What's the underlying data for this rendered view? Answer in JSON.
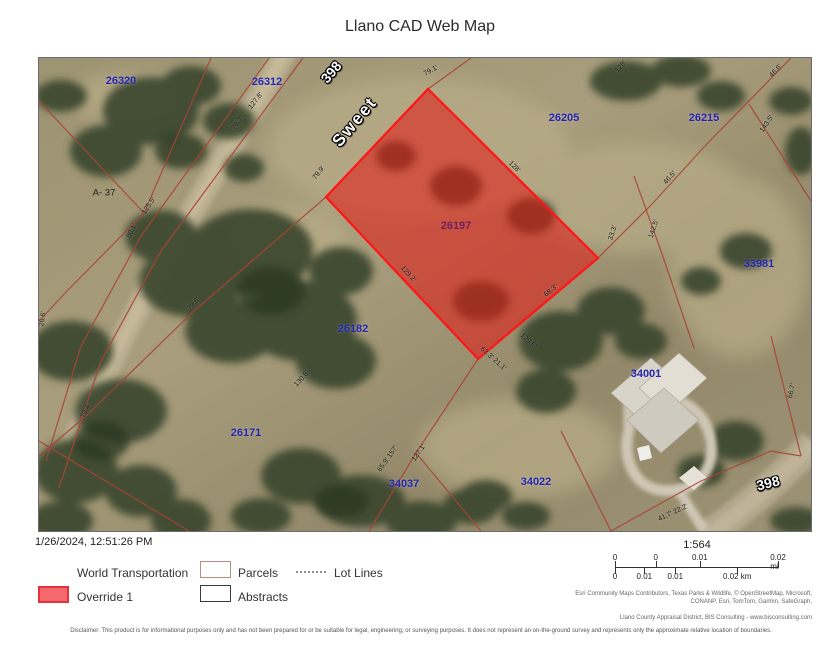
{
  "title": "Llano CAD Web Map",
  "map": {
    "highlight": {
      "parcel_id": "26197",
      "fill_color": "#e01c16",
      "border_color": "#ff1515"
    },
    "parcel_line_color": "#a84436",
    "labels": [
      {
        "type": "road",
        "text": "398",
        "x": 292,
        "y": 14,
        "rot": -50
      },
      {
        "type": "road-name",
        "text": "Sweet",
        "x": 316,
        "y": 64,
        "rot": -50
      },
      {
        "type": "road",
        "text": "398",
        "x": 729,
        "y": 425,
        "rot": -14
      },
      {
        "type": "parcel-id",
        "text": "26320",
        "x": 82,
        "y": 23,
        "rot": 0
      },
      {
        "type": "parcel-id",
        "text": "26312",
        "x": 228,
        "y": 24,
        "rot": 0
      },
      {
        "type": "parcel-id",
        "text": "26205",
        "x": 525,
        "y": 60,
        "rot": 0
      },
      {
        "type": "parcel-id",
        "text": "26215",
        "x": 665,
        "y": 60,
        "rot": 0
      },
      {
        "type": "parcel-id",
        "text": "33981",
        "x": 720,
        "y": 206,
        "rot": 0
      },
      {
        "type": "parcel-id",
        "text": "26182",
        "x": 314,
        "y": 271,
        "rot": 0
      },
      {
        "type": "parcel-id",
        "text": "26171",
        "x": 207,
        "y": 375,
        "rot": 0
      },
      {
        "type": "parcel-id",
        "text": "34037",
        "x": 365,
        "y": 426,
        "rot": 0
      },
      {
        "type": "parcel-id",
        "text": "34022",
        "x": 497,
        "y": 424,
        "rot": 0
      },
      {
        "type": "parcel-id",
        "text": "34001",
        "x": 607,
        "y": 316,
        "rot": 0
      },
      {
        "type": "parcel-hl",
        "text": "26197",
        "x": 417,
        "y": 168,
        "rot": 0
      },
      {
        "type": "abstract",
        "text": "A- 37",
        "x": 65,
        "y": 135,
        "rot": 0
      },
      {
        "type": "dim",
        "text": "127.8'",
        "x": 217,
        "y": 43,
        "rot": -52
      },
      {
        "type": "dim",
        "text": "78.7'",
        "x": 199,
        "y": 65,
        "rot": -52
      },
      {
        "type": "dim",
        "text": "79.1'",
        "x": 392,
        "y": 13,
        "rot": -28
      },
      {
        "type": "dim",
        "text": "79.9'",
        "x": 280,
        "y": 115,
        "rot": -50
      },
      {
        "type": "dim",
        "text": "128'",
        "x": 475,
        "y": 109,
        "rot": 45
      },
      {
        "type": "dim",
        "text": "128'",
        "x": 582,
        "y": 9,
        "rot": -48
      },
      {
        "type": "dim",
        "text": "129.2'",
        "x": 369,
        "y": 216,
        "rot": 47
      },
      {
        "type": "dim",
        "text": "68.3'",
        "x": 512,
        "y": 233,
        "rot": -40
      },
      {
        "type": "dim",
        "text": "33.3'",
        "x": 574,
        "y": 175,
        "rot": -72
      },
      {
        "type": "dim",
        "text": "142.5'",
        "x": 615,
        "y": 171,
        "rot": -72
      },
      {
        "type": "dim",
        "text": "46.5'",
        "x": 631,
        "y": 120,
        "rot": -48
      },
      {
        "type": "dim",
        "text": "46.6'",
        "x": 737,
        "y": 13,
        "rot": -48
      },
      {
        "type": "dim",
        "text": "143.5'",
        "x": 728,
        "y": 66,
        "rot": -55
      },
      {
        "type": "dim",
        "text": "129.6'",
        "x": 489,
        "y": 283,
        "rot": 42
      },
      {
        "type": "dim",
        "text": "63.3' 21.1'",
        "x": 454,
        "y": 301,
        "rot": 42
      },
      {
        "type": "dim",
        "text": "80.1'",
        "x": 93,
        "y": 173,
        "rot": -65
      },
      {
        "type": "dim",
        "text": "125.5'",
        "x": 110,
        "y": 148,
        "rot": -55
      },
      {
        "type": "dim",
        "text": "79.8'",
        "x": 155,
        "y": 246,
        "rot": -48
      },
      {
        "type": "dim",
        "text": "130.8'",
        "x": 263,
        "y": 321,
        "rot": -48
      },
      {
        "type": "dim",
        "text": "79.4'",
        "x": 47,
        "y": 353,
        "rot": -65
      },
      {
        "type": "dim",
        "text": "26.6'",
        "x": 4,
        "y": 261,
        "rot": -80
      },
      {
        "type": "dim",
        "text": "65.9' 157'",
        "x": 349,
        "y": 401,
        "rot": -55
      },
      {
        "type": "dim",
        "text": "127.1'",
        "x": 380,
        "y": 395,
        "rot": -55
      },
      {
        "type": "dim",
        "text": "66.7'",
        "x": 753,
        "y": 333,
        "rot": -78
      },
      {
        "type": "dim",
        "text": "41.7' 22.2'",
        "x": 634,
        "y": 455,
        "rot": -25
      }
    ]
  },
  "footer": {
    "timestamp": "1/26/2024, 12:51:26 PM",
    "legend": {
      "items": [
        {
          "label": "World Transportation"
        },
        {
          "label": "Parcels"
        },
        {
          "label": "Lot Lines"
        },
        {
          "label": "Override 1"
        },
        {
          "label": "Abstracts"
        }
      ]
    },
    "scalebar": {
      "ratio": "1:564",
      "mi": [
        {
          "t": "0",
          "p": 0
        },
        {
          "t": "0",
          "p": 25
        },
        {
          "t": "0.01",
          "p": 52
        },
        {
          "t": "0.02 mi",
          "p": 100
        }
      ],
      "km": [
        {
          "t": "0",
          "p": 0
        },
        {
          "t": "0.01",
          "p": 18
        },
        {
          "t": "0.01",
          "p": 37
        },
        {
          "t": "0.02 km",
          "p": 75
        }
      ]
    },
    "attribution": "Esri Community Maps Contributors, Texas Parks & Wildlife, © OpenStreetMap, Microsoft, CONANP, Esri, TomTom, Garmin, SafeGraph,",
    "credit": "Llano County Appraisal District, BIS Consulting - www.bisconsulting.com",
    "disclaimer": "Disclaimer: This product is for informational purposes only and has not been prepared for or be suitable for legal, engineering, or surveying purposes. It does not represent an on-the-ground survey and represents only the approximate relative location of boundaries."
  }
}
